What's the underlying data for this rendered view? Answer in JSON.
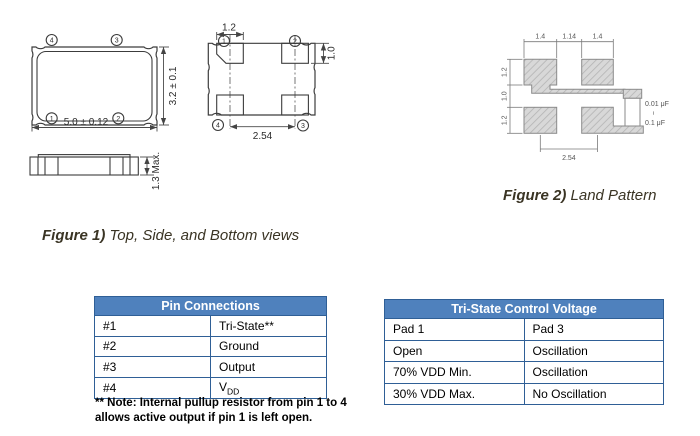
{
  "figure1": {
    "caption": {
      "bold": "Figure 1)",
      "text": "Top, Side, and Bottom views"
    },
    "top_view": {
      "width_dim": "5.0 ± 0.12",
      "height_dim": "3.2 ± 0.1",
      "pin_top_left": "4",
      "pin_top_right": "3",
      "pin_bottom_left": "1",
      "pin_bottom_right": "2"
    },
    "side_view": {
      "height_dim": "1.3 Max."
    },
    "bottom_view": {
      "pad_width_dim": "1.2",
      "pad_height_dim": "1.0",
      "pitch_dim": "2.54",
      "pin_top_left": "1",
      "pin_top_right": "2",
      "pin_bottom_left": "4",
      "pin_bottom_right": "3"
    }
  },
  "figure2": {
    "caption": {
      "bold": "Figure 2)",
      "text": "Land Pattern"
    },
    "dims": {
      "pad_w_left": "1.4",
      "gap": "1.14",
      "pad_w_right": "1.4",
      "pad_h_top": "1.2",
      "row_gap": "1.0",
      "pad_h_bottom": "1.2",
      "pitch": "2.54"
    },
    "capacitor": {
      "min": "0.01 μF",
      "tilde": "~",
      "max": "0.1 μF"
    }
  },
  "pin_table": {
    "title": "Pin Connections",
    "rows": [
      {
        "pin": "#1",
        "fn": "Tri-State**"
      },
      {
        "pin": "#2",
        "fn": "Ground"
      },
      {
        "pin": "#3",
        "fn": "Output"
      },
      {
        "pin": "#4",
        "fn": "V",
        "fn_sub": "DD"
      }
    ],
    "note_line1": "** Note: Internal pullup resistor from pin 1 to 4",
    "note_line2": "allows active output if pin 1 is left open."
  },
  "tristate_table": {
    "title": "Tri-State Control Voltage",
    "rows": [
      {
        "pad1": "Pad 1",
        "pad3": "Pad 3"
      },
      {
        "pad1": "Open",
        "pad3": "Oscillation"
      },
      {
        "pad1": "70% VDD Min.",
        "pad3": "Oscillation"
      },
      {
        "pad1": "30% VDD Max.",
        "pad3": "No Oscillation"
      }
    ]
  },
  "colors": {
    "header_blue": "#4f81bd",
    "table_border": "#2f5f96",
    "caption": "#3a3424"
  }
}
